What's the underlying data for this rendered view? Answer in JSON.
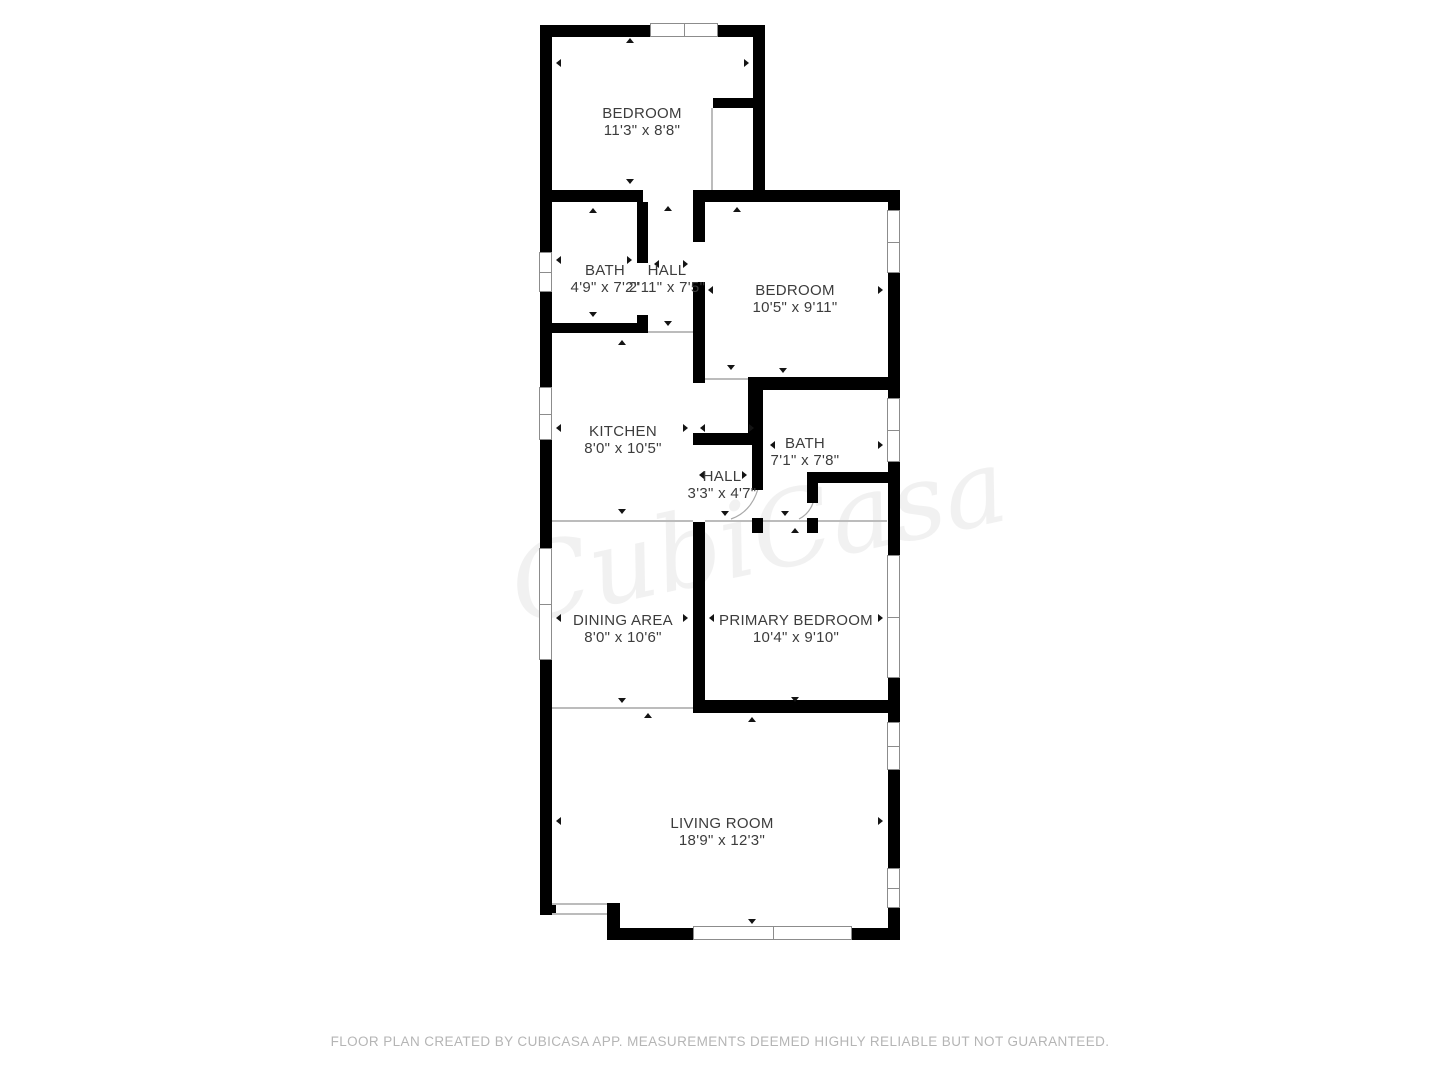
{
  "footer": {
    "text": "FLOOR PLAN CREATED BY CUBICASA APP. MEASUREMENTS DEEMED HIGHLY RELIABLE BUT NOT GUARANTEED."
  },
  "watermark": "CubiCasa",
  "colors": {
    "wall": "#000000",
    "window_frame": "#8c8c8c",
    "open_line": "#bcbcbc",
    "label": "#3c3c3c",
    "footer": "#b5b5b5"
  },
  "rooms": [
    {
      "id": "bedroom-top",
      "name": "BEDROOM",
      "dims": "11'3\" x 8'8\"",
      "cx": 642,
      "cy": 122
    },
    {
      "id": "bath-top",
      "name": "BATH",
      "dims": "4'9\" x 7'2\"",
      "cx": 605,
      "cy": 279
    },
    {
      "id": "hall-top",
      "name": "HALL",
      "dims": "2'11\" x 7'5\"",
      "cx": 667,
      "cy": 279
    },
    {
      "id": "bedroom-right",
      "name": "BEDROOM",
      "dims": "10'5\" x 9'11\"",
      "cx": 795,
      "cy": 299
    },
    {
      "id": "kitchen",
      "name": "KITCHEN",
      "dims": "8'0\" x 10'5\"",
      "cx": 623,
      "cy": 440
    },
    {
      "id": "bath-middle",
      "name": "BATH",
      "dims": "7'1\" x 7'8\"",
      "cx": 805,
      "cy": 452
    },
    {
      "id": "hall-middle",
      "name": "HALL",
      "dims": "3'3\" x 4'7\"",
      "cx": 722,
      "cy": 485
    },
    {
      "id": "dining-area",
      "name": "DINING AREA",
      "dims": "8'0\" x 10'6\"",
      "cx": 623,
      "cy": 629
    },
    {
      "id": "primary-bedroom",
      "name": "PRIMARY BEDROOM",
      "dims": "10'4\" x 9'10\"",
      "cx": 796,
      "cy": 629
    },
    {
      "id": "living-room",
      "name": "LIVING ROOM",
      "dims": "18'9\" x 12'3\"",
      "cx": 722,
      "cy": 832
    }
  ],
  "geometry": {
    "walls": [
      [
        540,
        25,
        110,
        12
      ],
      [
        718,
        25,
        47,
        12
      ],
      [
        540,
        25,
        12,
        227
      ],
      [
        540,
        292,
        12,
        95
      ],
      [
        540,
        440,
        12,
        108
      ],
      [
        540,
        660,
        12,
        243
      ],
      [
        540,
        903,
        16,
        12
      ],
      [
        753,
        25,
        12,
        177
      ],
      [
        713,
        98,
        40,
        10
      ],
      [
        540,
        190,
        103,
        12
      ],
      [
        693,
        190,
        207,
        12
      ],
      [
        888,
        190,
        12,
        20
      ],
      [
        888,
        273,
        12,
        125
      ],
      [
        888,
        462,
        12,
        93
      ],
      [
        888,
        678,
        12,
        44
      ],
      [
        888,
        770,
        12,
        98
      ],
      [
        888,
        908,
        12,
        32
      ],
      [
        607,
        903,
        13,
        37
      ],
      [
        607,
        928,
        86,
        12
      ],
      [
        852,
        928,
        48,
        12
      ],
      [
        637,
        202,
        11,
        61
      ],
      [
        637,
        315,
        11,
        18
      ],
      [
        552,
        323,
        96,
        10
      ],
      [
        693,
        202,
        12,
        40
      ],
      [
        693,
        282,
        12,
        101
      ],
      [
        693,
        433,
        65,
        12
      ],
      [
        748,
        381,
        10,
        52
      ],
      [
        748,
        377,
        152,
        13
      ],
      [
        752,
        390,
        11,
        100
      ],
      [
        752,
        518,
        11,
        15
      ],
      [
        815,
        472,
        85,
        11
      ],
      [
        807,
        472,
        11,
        31
      ],
      [
        807,
        518,
        11,
        15
      ],
      [
        693,
        522,
        12,
        190
      ],
      [
        693,
        700,
        207,
        13
      ]
    ],
    "thin_lines": [
      [
        711,
        108,
        2,
        82
      ],
      [
        648,
        331,
        45,
        2
      ],
      [
        705,
        378,
        43,
        2
      ],
      [
        552,
        520,
        141,
        2
      ],
      [
        705,
        520,
        47,
        2
      ],
      [
        763,
        520,
        44,
        2
      ],
      [
        818,
        520,
        69,
        2
      ],
      [
        552,
        707,
        141,
        2
      ],
      [
        552,
        903,
        55,
        2
      ],
      [
        552,
        913,
        55,
        2
      ]
    ],
    "windows": [
      [
        650,
        23,
        68,
        14
      ],
      [
        539,
        252,
        13,
        40
      ],
      [
        539,
        387,
        13,
        53
      ],
      [
        539,
        548,
        13,
        112
      ],
      [
        887,
        210,
        13,
        63
      ],
      [
        887,
        398,
        13,
        64
      ],
      [
        887,
        555,
        13,
        123
      ],
      [
        887,
        722,
        13,
        48
      ],
      [
        887,
        868,
        13,
        40
      ],
      [
        693,
        926,
        159,
        14
      ]
    ],
    "arcs": [
      "M758 489 Q751 512 731 519",
      "M813 503 Q809 514 799 519"
    ],
    "triangles": [
      [
        630,
        38,
        "up"
      ],
      [
        630,
        184,
        "down"
      ],
      [
        556,
        63,
        "left"
      ],
      [
        749,
        63,
        "right"
      ],
      [
        668,
        206,
        "up"
      ],
      [
        593,
        208,
        "up"
      ],
      [
        593,
        317,
        "down"
      ],
      [
        556,
        260,
        "left"
      ],
      [
        632,
        260,
        "right"
      ],
      [
        654,
        264,
        "left"
      ],
      [
        688,
        264,
        "right"
      ],
      [
        668,
        326,
        "down"
      ],
      [
        737,
        207,
        "up"
      ],
      [
        731,
        370,
        "down"
      ],
      [
        708,
        290,
        "left"
      ],
      [
        883,
        290,
        "right"
      ],
      [
        622,
        340,
        "up"
      ],
      [
        622,
        514,
        "down"
      ],
      [
        556,
        428,
        "left"
      ],
      [
        688,
        428,
        "right"
      ],
      [
        700,
        428,
        "left"
      ],
      [
        754,
        428,
        "right"
      ],
      [
        783,
        373,
        "down"
      ],
      [
        770,
        445,
        "left"
      ],
      [
        883,
        445,
        "right"
      ],
      [
        699,
        475,
        "left"
      ],
      [
        747,
        475,
        "right"
      ],
      [
        725,
        516,
        "down"
      ],
      [
        785,
        516,
        "down"
      ],
      [
        795,
        528,
        "up"
      ],
      [
        709,
        618,
        "left"
      ],
      [
        883,
        618,
        "right"
      ],
      [
        795,
        702,
        "down"
      ],
      [
        752,
        717,
        "up"
      ],
      [
        556,
        618,
        "left"
      ],
      [
        688,
        618,
        "right"
      ],
      [
        622,
        703,
        "down"
      ],
      [
        648,
        713,
        "up"
      ],
      [
        556,
        821,
        "left"
      ],
      [
        883,
        821,
        "right"
      ],
      [
        752,
        924,
        "down"
      ]
    ]
  }
}
